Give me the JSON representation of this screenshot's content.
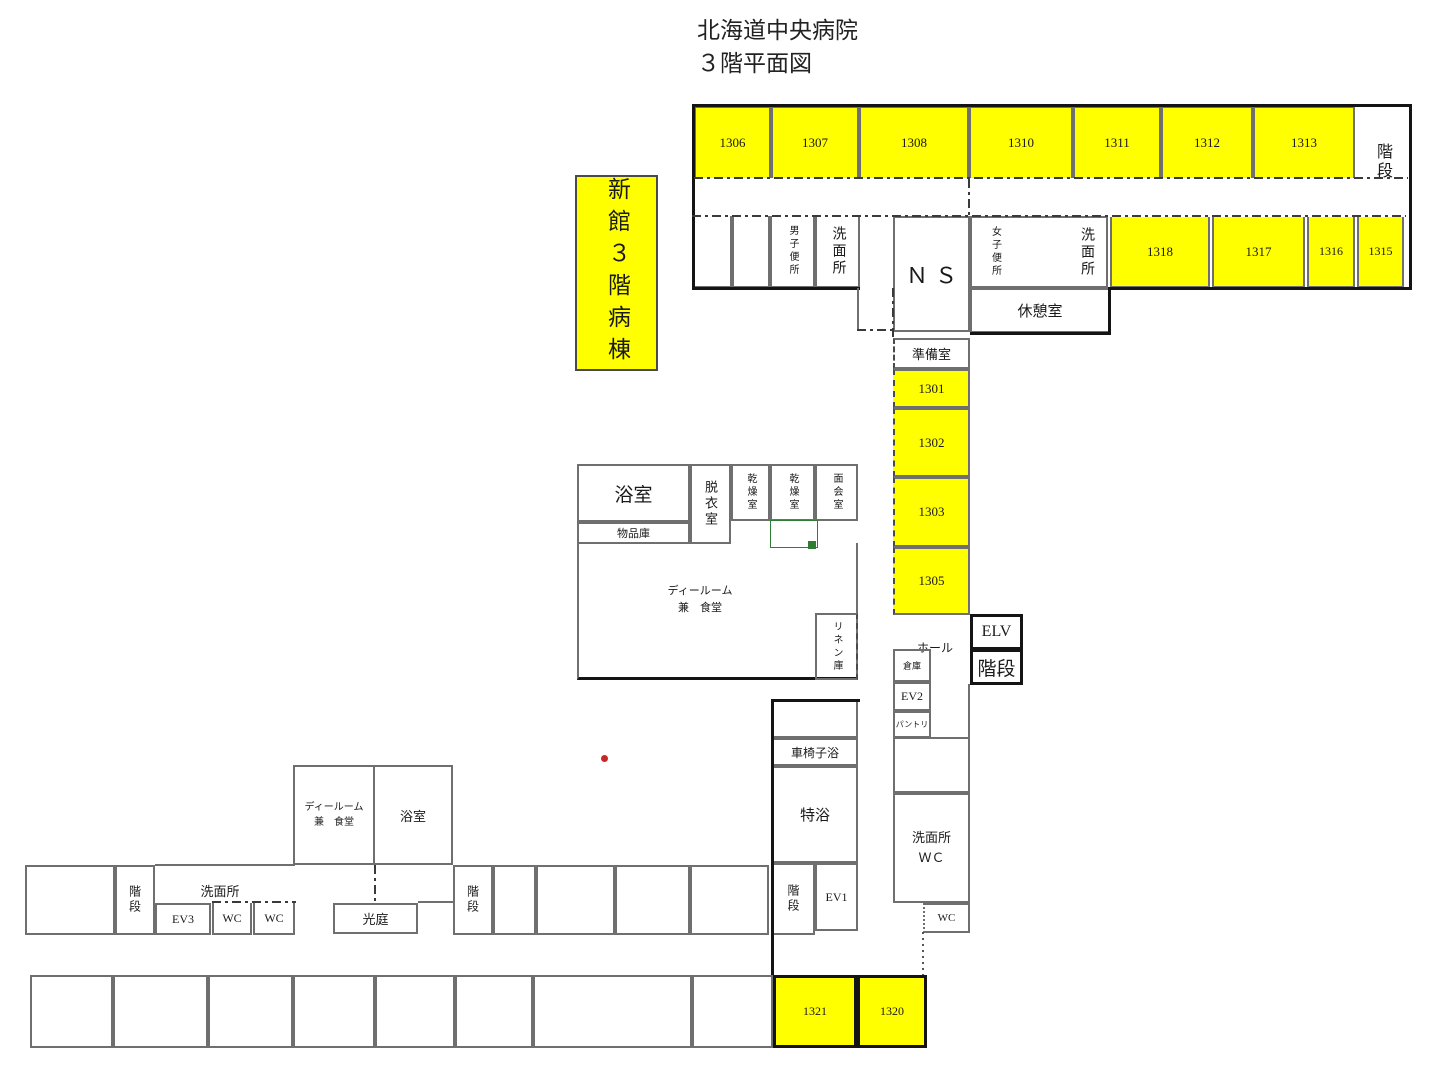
{
  "title": {
    "line1": "北海道中央病院",
    "line2": "３階平面図"
  },
  "wing_label": "新館３階病棟",
  "colors": {
    "room_highlight": "#ffff00",
    "wall": "#6f6f6f",
    "outer_wall": "#141414",
    "marker_red": "#c62828",
    "marker_green": "#2e7d32"
  },
  "rooms": [
    {
      "name": "room-1306",
      "label": "1306",
      "box": [
        694,
        106,
        77,
        72
      ],
      "cls": "yellow no-bottom",
      "fs": 13
    },
    {
      "name": "room-1307",
      "label": "1307",
      "box": [
        771,
        106,
        88,
        72
      ],
      "cls": "yellow no-bottom",
      "fs": 13
    },
    {
      "name": "room-1308",
      "label": "1308",
      "box": [
        859,
        106,
        110,
        72
      ],
      "cls": "yellow no-bottom",
      "fs": 13
    },
    {
      "name": "room-1310",
      "label": "1310",
      "box": [
        969,
        106,
        104,
        72
      ],
      "cls": "yellow no-bottom",
      "fs": 13
    },
    {
      "name": "room-1311",
      "label": "1311",
      "box": [
        1073,
        106,
        88,
        72
      ],
      "cls": "yellow no-bottom",
      "fs": 13
    },
    {
      "name": "room-1312",
      "label": "1312",
      "box": [
        1161,
        106,
        92,
        72
      ],
      "cls": "yellow no-bottom",
      "fs": 13
    },
    {
      "name": "room-1313",
      "label": "1313",
      "box": [
        1253,
        106,
        102,
        72
      ],
      "cls": "yellow no-bottom",
      "fs": 13
    },
    {
      "name": "stairs-top-right",
      "label": "階段",
      "box": [
        1360,
        112,
        44,
        100
      ],
      "cls": "noborder vtext",
      "fs": 16
    },
    {
      "name": "room-empty-a",
      "label": "",
      "box": [
        692,
        216,
        40,
        72
      ],
      "cls": "no-top",
      "fs": 12
    },
    {
      "name": "room-empty-b",
      "label": "",
      "box": [
        732,
        216,
        38,
        72
      ],
      "cls": "no-top",
      "fs": 12
    },
    {
      "name": "mens-toilet",
      "label": "男子便所",
      "box": [
        770,
        216,
        45,
        72
      ],
      "cls": "vtext no-top",
      "fs": 10
    },
    {
      "name": "washroom-west",
      "label": "洗面所",
      "box": [
        815,
        216,
        45,
        72
      ],
      "cls": "vtext no-top",
      "fs": 14
    },
    {
      "name": "nurse-station",
      "label": "ＮＳ",
      "box": [
        893,
        216,
        77,
        116
      ],
      "cls": "serif-wide",
      "fs": 22
    },
    {
      "name": "womens-toilet-block",
      "label": "",
      "box": [
        970,
        216,
        138,
        72
      ],
      "cls": "",
      "fs": 10
    },
    {
      "name": "womens-toilet-label",
      "label": "女子便所",
      "box": [
        978,
        220,
        34,
        64
      ],
      "cls": "noborder vtext",
      "fs": 10
    },
    {
      "name": "washroom-east-label",
      "label": "洗面所",
      "box": [
        1070,
        220,
        32,
        64
      ],
      "cls": "noborder vtext",
      "fs": 14
    },
    {
      "name": "break-room",
      "label": "休憩室",
      "box": [
        970,
        288,
        140,
        45
      ],
      "cls": "",
      "fs": 15
    },
    {
      "name": "room-1318",
      "label": "1318",
      "box": [
        1110,
        217,
        100,
        71
      ],
      "cls": "yellow no-top",
      "fs": 13
    },
    {
      "name": "room-1317",
      "label": "1317",
      "box": [
        1212,
        217,
        93,
        71
      ],
      "cls": "yellow no-top",
      "fs": 13
    },
    {
      "name": "room-1316",
      "label": "1316",
      "box": [
        1307,
        217,
        48,
        71
      ],
      "cls": "yellow no-top",
      "fs": 12
    },
    {
      "name": "room-1315",
      "label": "1315",
      "box": [
        1357,
        217,
        47,
        71
      ],
      "cls": "yellow no-top",
      "fs": 12
    },
    {
      "name": "bath-main",
      "label": "浴室",
      "box": [
        577,
        464,
        113,
        58
      ],
      "cls": "",
      "fs": 19
    },
    {
      "name": "goods-storage",
      "label": "物品庫",
      "box": [
        577,
        522,
        113,
        22
      ],
      "cls": "",
      "fs": 11
    },
    {
      "name": "dressing-room",
      "label": "脱衣室",
      "box": [
        690,
        464,
        41,
        80
      ],
      "cls": "vtext",
      "fs": 13
    },
    {
      "name": "drying-room-1",
      "label": "乾燥室",
      "box": [
        731,
        464,
        39,
        57
      ],
      "cls": "vtext",
      "fs": 10
    },
    {
      "name": "drying-room-2",
      "label": "乾燥室",
      "box": [
        770,
        464,
        45,
        57
      ],
      "cls": "vtext",
      "fs": 10
    },
    {
      "name": "visiting-room",
      "label": "面会室",
      "box": [
        815,
        464,
        43,
        57
      ],
      "cls": "vtext",
      "fs": 10
    },
    {
      "name": "day-room-main",
      "label": "",
      "box": [
        577,
        543,
        281,
        137
      ],
      "cls": "no-top thick-bottom",
      "fs": 11
    },
    {
      "name": "day-room-main-label",
      "label": "ディールーム\n兼　食堂",
      "box": [
        640,
        578,
        120,
        44
      ],
      "cls": "noborder pre",
      "fs": 11
    },
    {
      "name": "linen-storage",
      "label": "リネン庫",
      "box": [
        815,
        613,
        43,
        67
      ],
      "cls": "vtext dash-right",
      "fs": 10
    },
    {
      "name": "prep-room",
      "label": "準備室",
      "box": [
        893,
        338,
        77,
        31
      ],
      "cls": "dash-left",
      "fs": 13
    },
    {
      "name": "room-1301",
      "label": "1301",
      "box": [
        893,
        369,
        77,
        39
      ],
      "cls": "yellow dash-left",
      "fs": 13
    },
    {
      "name": "room-1302",
      "label": "1302",
      "box": [
        893,
        408,
        77,
        69
      ],
      "cls": "yellow dash-left",
      "fs": 13
    },
    {
      "name": "room-1303",
      "label": "1303",
      "box": [
        893,
        477,
        77,
        70
      ],
      "cls": "yellow dash-left",
      "fs": 13
    },
    {
      "name": "room-1305",
      "label": "1305",
      "box": [
        893,
        547,
        77,
        68
      ],
      "cls": "yellow dash-left",
      "fs": 13
    },
    {
      "name": "hall-label",
      "label": "ホール",
      "box": [
        906,
        636,
        58,
        22
      ],
      "cls": "noborder",
      "fs": 12
    },
    {
      "name": "elevator-elv",
      "label": "ELV",
      "box": [
        970,
        614,
        53,
        36
      ],
      "cls": "thick",
      "fs": 16
    },
    {
      "name": "stairs-elv",
      "label": "階段",
      "box": [
        970,
        649,
        53,
        36
      ],
      "cls": "thick",
      "fs": 19
    },
    {
      "name": "storehouse",
      "label": "倉庫",
      "box": [
        893,
        649,
        38,
        33
      ],
      "cls": "",
      "fs": 9
    },
    {
      "name": "elevator-ev2",
      "label": "EV2",
      "box": [
        893,
        682,
        38,
        29
      ],
      "cls": "",
      "fs": 12
    },
    {
      "name": "pantry",
      "label": "パントリ",
      "box": [
        893,
        711,
        38,
        27
      ],
      "cls": "",
      "fs": 8
    },
    {
      "name": "washroom-wc-upper",
      "label": "",
      "box": [
        893,
        737,
        77,
        56
      ],
      "cls": "",
      "fs": 10
    },
    {
      "name": "washroom-wc",
      "label": "洗面所\nＷＣ",
      "box": [
        893,
        793,
        77,
        110
      ],
      "cls": "pre",
      "fs": 13
    },
    {
      "name": "wc-small-right",
      "label": "WC",
      "box": [
        923,
        903,
        47,
        30
      ],
      "cls": "dot-left",
      "fs": 11
    },
    {
      "name": "room-empty-tokuyoku-top",
      "label": "",
      "box": [
        772,
        700,
        86,
        38
      ],
      "cls": "",
      "fs": 10
    },
    {
      "name": "wheelchair-bath",
      "label": "車椅子浴",
      "box": [
        772,
        738,
        86,
        28
      ],
      "cls": "",
      "fs": 12
    },
    {
      "name": "special-bath",
      "label": "特浴",
      "box": [
        772,
        766,
        86,
        97
      ],
      "cls": "",
      "fs": 15
    },
    {
      "name": "stairs-south",
      "label": "階段",
      "box": [
        772,
        863,
        43,
        72
      ],
      "cls": "vtext",
      "fs": 12
    },
    {
      "name": "elevator-ev1",
      "label": "EV1",
      "box": [
        815,
        863,
        43,
        68
      ],
      "cls": "",
      "fs": 12
    },
    {
      "name": "day-room-2",
      "label": "ディールーム\n兼　食堂",
      "box": [
        293,
        765,
        82,
        100
      ],
      "cls": "pre",
      "fs": 10
    },
    {
      "name": "bath-2",
      "label": "浴室",
      "box": [
        375,
        765,
        78,
        100
      ],
      "cls": "no-left",
      "fs": 13
    },
    {
      "name": "room-empty-c",
      "label": "",
      "box": [
        25,
        865,
        90,
        70
      ],
      "cls": "",
      "fs": 10
    },
    {
      "name": "stairs-west",
      "label": "階段",
      "box": [
        115,
        865,
        40,
        70
      ],
      "cls": "vtext",
      "fs": 12
    },
    {
      "name": "washroom-label-west",
      "label": "洗面所",
      "box": [
        175,
        880,
        90,
        20
      ],
      "cls": "noborder",
      "fs": 13
    },
    {
      "name": "elevator-ev3",
      "label": "EV3",
      "box": [
        155,
        903,
        56,
        32
      ],
      "cls": "",
      "fs": 12
    },
    {
      "name": "wc-west-1",
      "label": "WC",
      "box": [
        212,
        903,
        40,
        32
      ],
      "cls": "no-top",
      "fs": 12
    },
    {
      "name": "wc-west-2",
      "label": "WC",
      "box": [
        253,
        903,
        42,
        32
      ],
      "cls": "no-top",
      "fs": 12
    },
    {
      "name": "light-court",
      "label": "光庭",
      "box": [
        333,
        903,
        85,
        31
      ],
      "cls": "",
      "fs": 13
    },
    {
      "name": "stairs-mid",
      "label": "階段",
      "box": [
        453,
        865,
        40,
        70
      ],
      "cls": "vtext",
      "fs": 12
    },
    {
      "name": "room-empty-d",
      "label": "",
      "box": [
        493,
        865,
        43,
        70
      ],
      "cls": "",
      "fs": 10
    },
    {
      "name": "room-empty-e",
      "label": "",
      "box": [
        536,
        865,
        79,
        70
      ],
      "cls": "",
      "fs": 10
    },
    {
      "name": "room-empty-f",
      "label": "",
      "box": [
        615,
        865,
        75,
        70
      ],
      "cls": "",
      "fs": 10
    },
    {
      "name": "room-empty-g",
      "label": "",
      "box": [
        690,
        865,
        79,
        70
      ],
      "cls": "",
      "fs": 10
    },
    {
      "name": "room-empty-h",
      "label": "",
      "box": [
        30,
        975,
        83,
        73
      ],
      "cls": "",
      "fs": 10
    },
    {
      "name": "room-empty-i",
      "label": "",
      "box": [
        113,
        975,
        95,
        73
      ],
      "cls": "",
      "fs": 10
    },
    {
      "name": "room-empty-j",
      "label": "",
      "box": [
        208,
        975,
        85,
        73
      ],
      "cls": "",
      "fs": 10
    },
    {
      "name": "room-empty-k",
      "label": "",
      "box": [
        293,
        975,
        82,
        73
      ],
      "cls": "",
      "fs": 10
    },
    {
      "name": "room-empty-l",
      "label": "",
      "box": [
        375,
        975,
        80,
        73
      ],
      "cls": "",
      "fs": 10
    },
    {
      "name": "room-empty-m",
      "label": "",
      "box": [
        455,
        975,
        78,
        73
      ],
      "cls": "",
      "fs": 10
    },
    {
      "name": "room-empty-n",
      "label": "",
      "box": [
        533,
        975,
        159,
        73
      ],
      "cls": "",
      "fs": 10
    },
    {
      "name": "room-empty-o",
      "label": "",
      "box": [
        692,
        975,
        81,
        73
      ],
      "cls": "",
      "fs": 10
    },
    {
      "name": "room-1321",
      "label": "1321",
      "box": [
        773,
        975,
        84,
        73
      ],
      "cls": "yellow thick",
      "fs": 12
    },
    {
      "name": "room-1320",
      "label": "1320",
      "box": [
        857,
        975,
        70,
        73
      ],
      "cls": "yellow thick",
      "fs": 12
    }
  ],
  "lines": [
    {
      "name": "outer-wall-top",
      "cls": "blk",
      "box": [
        692,
        104,
        720,
        3
      ]
    },
    {
      "name": "outer-wall-right",
      "cls": "blk",
      "box": [
        1409,
        104,
        3,
        186
      ]
    },
    {
      "name": "outer-wall-left",
      "cls": "blk",
      "box": [
        692,
        104,
        3,
        186
      ]
    },
    {
      "name": "outer-wall-bottom-west",
      "cls": "blk",
      "box": [
        692,
        287,
        168,
        3
      ]
    },
    {
      "name": "outer-wall-bottom-east",
      "cls": "blk",
      "box": [
        1108,
        287,
        304,
        3
      ]
    },
    {
      "name": "break-room-wall-right",
      "cls": "blk",
      "box": [
        1108,
        288,
        3,
        47
      ]
    },
    {
      "name": "break-room-wall-bottom",
      "cls": "blk",
      "box": [
        970,
        332,
        141,
        3
      ]
    },
    {
      "name": "corridor-line-top",
      "cls": "dd-h",
      "box": [
        694,
        177,
        714,
        2
      ]
    },
    {
      "name": "corridor-line-mid",
      "cls": "dd-h",
      "box": [
        692,
        215,
        714,
        2
      ]
    },
    {
      "name": "corridor-door-ns",
      "cls": "dd-v",
      "box": [
        968,
        179,
        2,
        38
      ]
    },
    {
      "name": "wall-toilet-corner",
      "cls": "sld",
      "box": [
        857,
        288,
        2,
        43
      ]
    },
    {
      "name": "corridor-door-west",
      "cls": "dd-h",
      "box": [
        857,
        329,
        38,
        2
      ]
    },
    {
      "name": "corridor-line-ns-left",
      "cls": "dd-v",
      "box": [
        892,
        288,
        2,
        50
      ]
    },
    {
      "name": "outer-wall-tokuyoku-left",
      "cls": "blk",
      "box": [
        771,
        699,
        3,
        276
      ]
    },
    {
      "name": "outer-wall-tokuyoku-top",
      "cls": "blk",
      "box": [
        771,
        699,
        89,
        3
      ]
    },
    {
      "name": "wall-right-corridor",
      "cls": "sld",
      "box": [
        968,
        684,
        2,
        53
      ]
    },
    {
      "name": "dotted-wc-passage",
      "cls": "dot-v",
      "box": [
        922,
        932,
        2,
        43
      ]
    },
    {
      "name": "corridor-door-bath2",
      "cls": "dd-v",
      "box": [
        374,
        865,
        2,
        38
      ]
    },
    {
      "name": "corridor-line-wc-west",
      "cls": "dd-h",
      "box": [
        212,
        901,
        84,
        2
      ]
    },
    {
      "name": "wall-light-court-link",
      "cls": "sld",
      "box": [
        418,
        901,
        35,
        2
      ]
    },
    {
      "name": "wall-corridor-west-top",
      "cls": "sld",
      "box": [
        155,
        864,
        140,
        2
      ]
    }
  ],
  "markers": [
    {
      "name": "green-outline-box",
      "type": "outline",
      "color": "#2e7d32",
      "box": [
        770,
        520,
        46,
        26
      ]
    },
    {
      "name": "green-square-marker",
      "type": "fill",
      "color": "#2e7d32",
      "box": [
        808,
        541,
        8,
        8
      ]
    },
    {
      "name": "red-dot-marker",
      "type": "dot",
      "color": "#c62828",
      "box": [
        601,
        755,
        7,
        7
      ]
    }
  ]
}
